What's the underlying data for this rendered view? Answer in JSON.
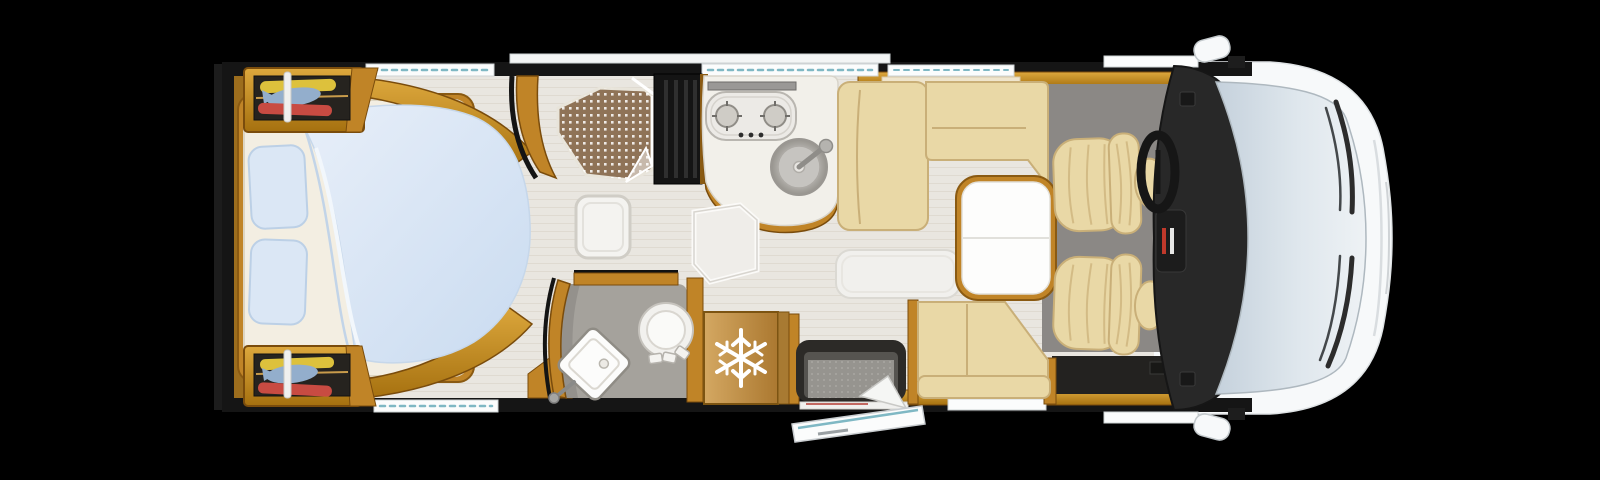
{
  "meta": {
    "title": "Motorhome floor plan — top view",
    "view": "overhead cutaway"
  },
  "theme": {
    "bg": "#000000",
    "wall": "#151515",
    "wood": "#c08427",
    "wood-dark": "#8a5a12",
    "floor": "#e9e6e0",
    "mattress": "#f3eee2",
    "bedding": "#dbe7f5",
    "sofa": "#e9d8a6",
    "sofa-shadow": "#c9af78",
    "carpet": "#8b8885",
    "dash": "#282828",
    "glass": "#d3dde6",
    "body": "#f7f9fa",
    "shower-tray": "#8f7357",
    "fridge-wood": "#c59a58",
    "washroom-floor": "#a5a29c",
    "steel": "#b9b7b2",
    "cloth-yellow": "#ddc13c",
    "cloth-blue": "#93aecc",
    "cloth-red": "#c84b42",
    "step-dark": "#2c2a27",
    "step-gray": "#96948f",
    "rug": "#f1f0ed",
    "window-white": "#fbfcfc",
    "accent-teal": "#7fb8c4"
  },
  "floorplan": {
    "vehicle": "motorhome",
    "fridge_icon": "snowflake",
    "areas": [
      {
        "id": "bedroom",
        "label": "Rear bedroom — island bed"
      },
      {
        "id": "wardrobe-top",
        "label": "Wardrobe with clothes (offside)"
      },
      {
        "id": "wardrobe-bottom",
        "label": "Wardrobe with clothes (nearside)"
      },
      {
        "id": "shower",
        "label": "Shower cubicle"
      },
      {
        "id": "tall-cabinet",
        "label": "Tall cabinet"
      },
      {
        "id": "kitchen",
        "label": "Kitchen — two-burner hob and sink"
      },
      {
        "id": "washroom",
        "label": "Washroom — toilet and basin"
      },
      {
        "id": "fridge",
        "label": "Refrigerator"
      },
      {
        "id": "dinette",
        "label": "L-shaped lounge with table"
      },
      {
        "id": "entry",
        "label": "Entrance step and open door"
      },
      {
        "id": "cab",
        "label": "Driver cab — swivel seats, dashboard, windscreen"
      }
    ]
  }
}
